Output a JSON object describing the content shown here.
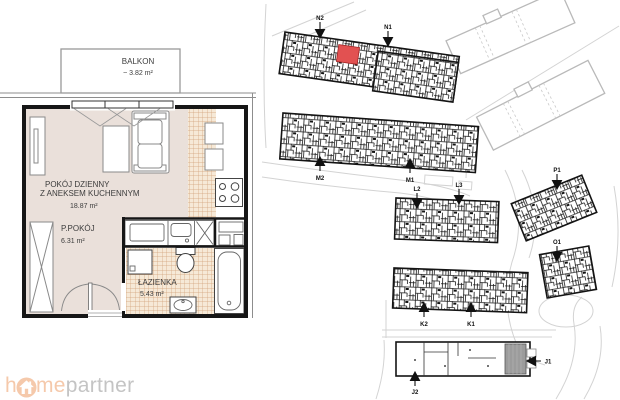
{
  "floor_plan": {
    "balcony": {
      "name": "BALKON",
      "area": "~ 3.82 m²"
    },
    "living_room": {
      "name_line1": "POKÓJ DZIENNY",
      "name_line2": "Z ANEKSEM KUCHENNYM",
      "area": "18.87 m²"
    },
    "hallway": {
      "name": "P.POKÓJ",
      "area": "6.31 m²"
    },
    "bathroom": {
      "name": "ŁAZIENKA",
      "area": "5.43 m²"
    },
    "colors": {
      "floor": "#eae0da",
      "tile_background": "#f6e9d7",
      "tile_line": "#d2a179",
      "wall": "#161616"
    }
  },
  "site_plan": {
    "highlighted_unit_color": "#e25151",
    "markers": [
      {
        "label": "N2"
      },
      {
        "label": "N1"
      },
      {
        "label": "M2"
      },
      {
        "label": "M1"
      },
      {
        "label": "L2"
      },
      {
        "label": "L3"
      },
      {
        "label": "K2"
      },
      {
        "label": "K1"
      },
      {
        "label": "P1"
      },
      {
        "label": "O1"
      },
      {
        "label": "J1"
      },
      {
        "label": "J2"
      }
    ]
  },
  "logo": {
    "part1": "h",
    "part2": "me",
    "part3": "partner",
    "icon": "home-icon",
    "accent_color": "#f5c9ab",
    "text_color": "#c4c4c4"
  }
}
